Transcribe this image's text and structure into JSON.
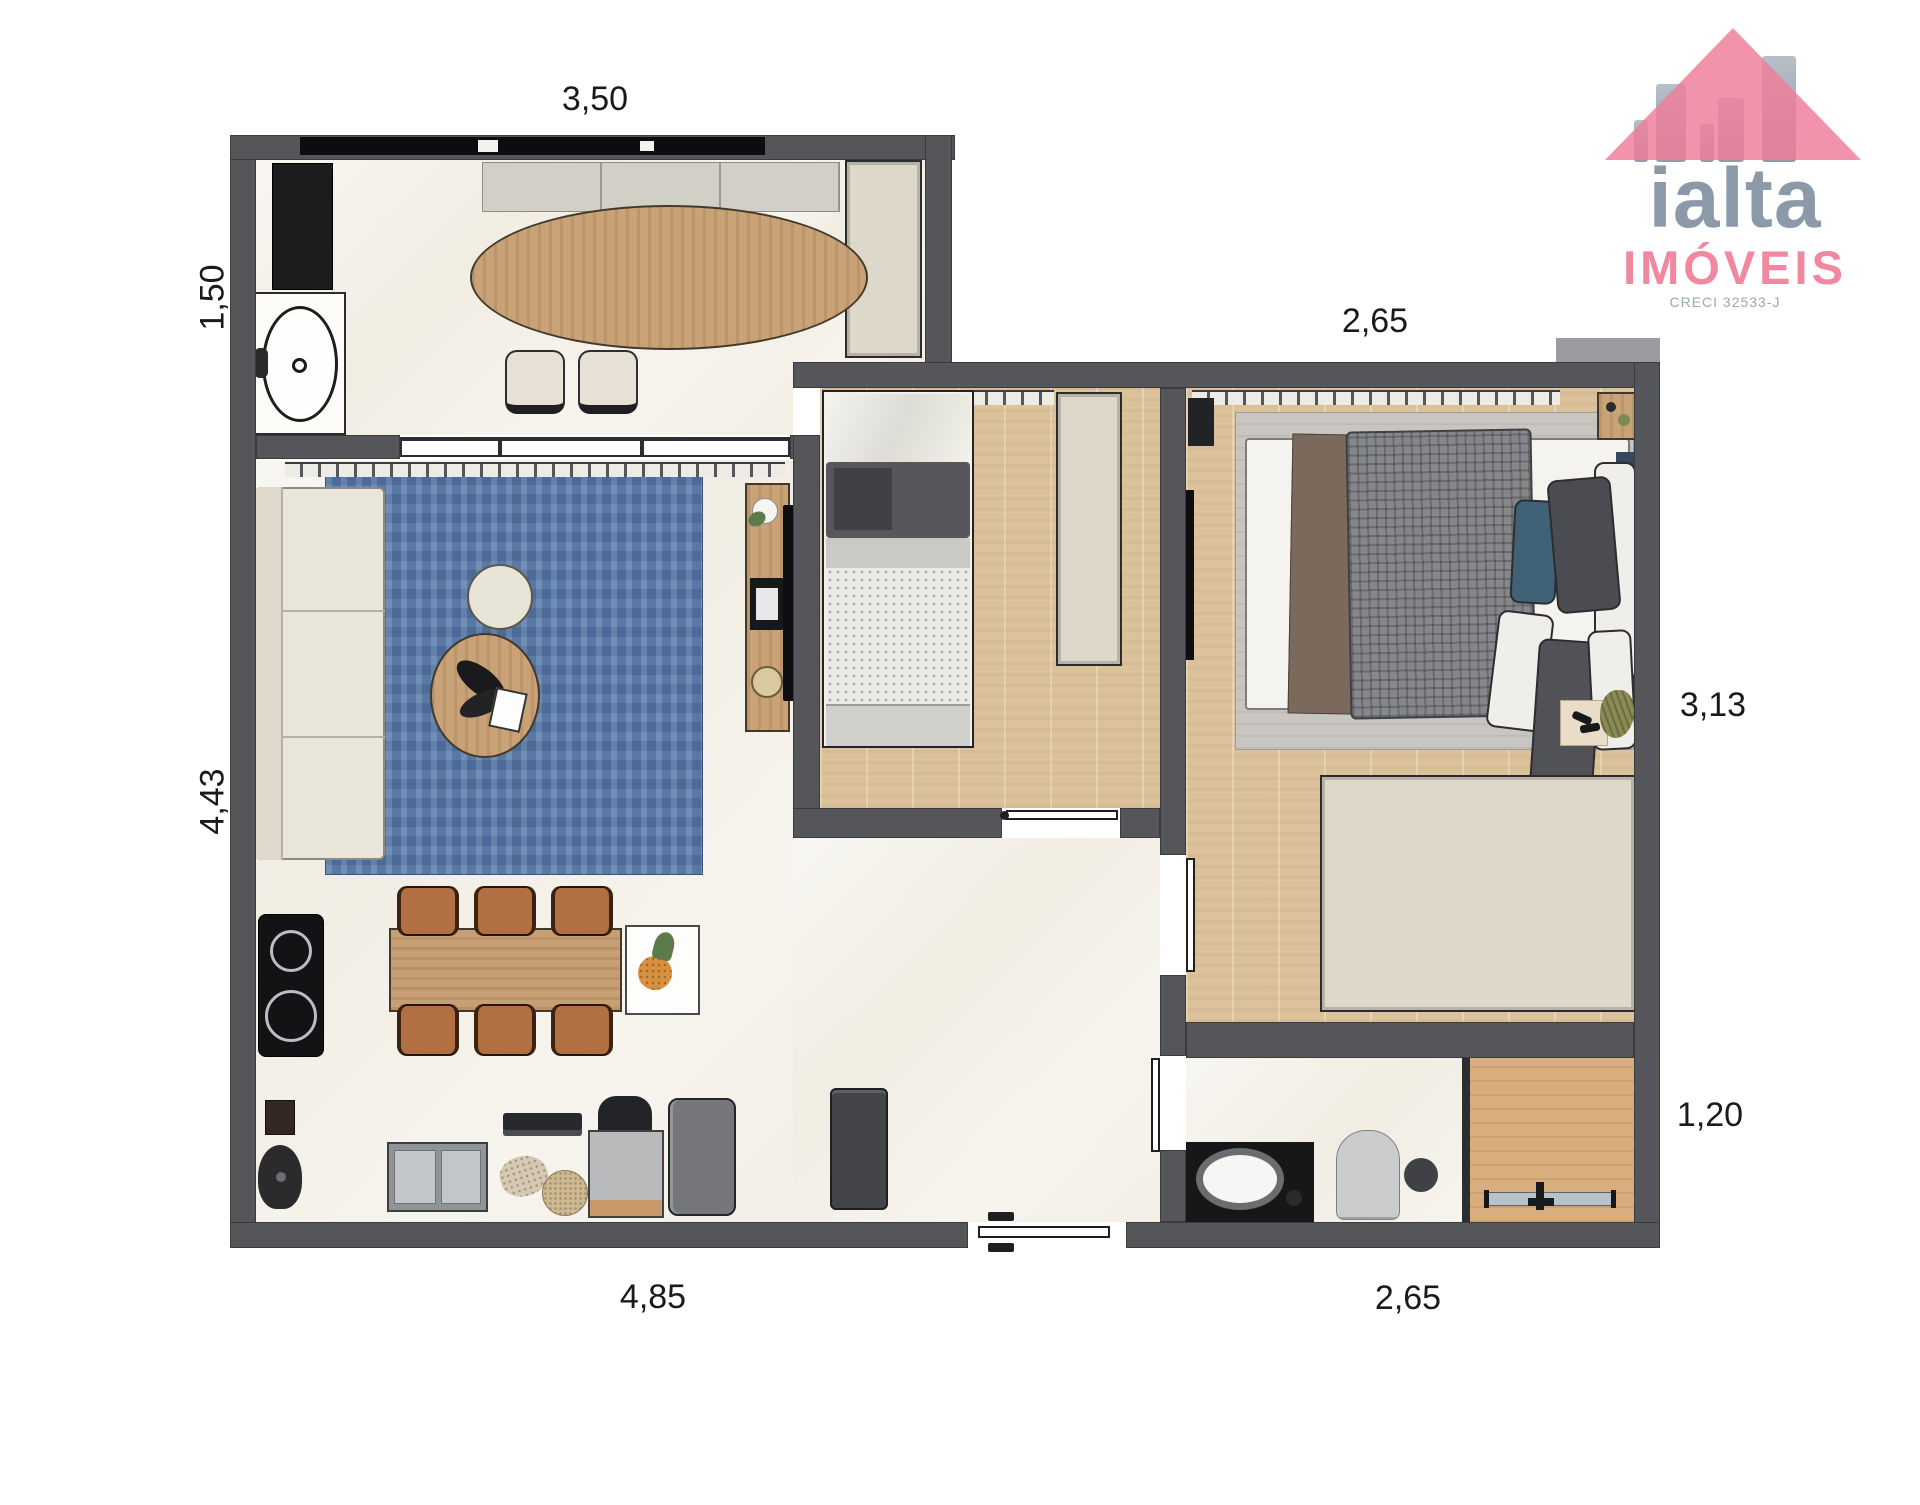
{
  "type": "floor_plan",
  "logo": {
    "brand": "ialta",
    "subtitle": "IMÓVEIS",
    "license": "CRECI 32533-J"
  },
  "dimensions": {
    "top": "3,50",
    "left_upper": "1,50",
    "left_lower": "4,43",
    "right_upper": "2,65",
    "right_middle": "3,13",
    "right_lower": "1,20",
    "bottom_left": "4,85",
    "bottom_right": "2,65"
  },
  "colors": {
    "wall_gray": "#55565a",
    "brand_pink": "#ee7d9a",
    "brand_gray": "#8b99a9",
    "rug_blue": "#5b7cab",
    "bedroom_wood": "#dcc29b",
    "furniture_wood": "#c9a377"
  }
}
